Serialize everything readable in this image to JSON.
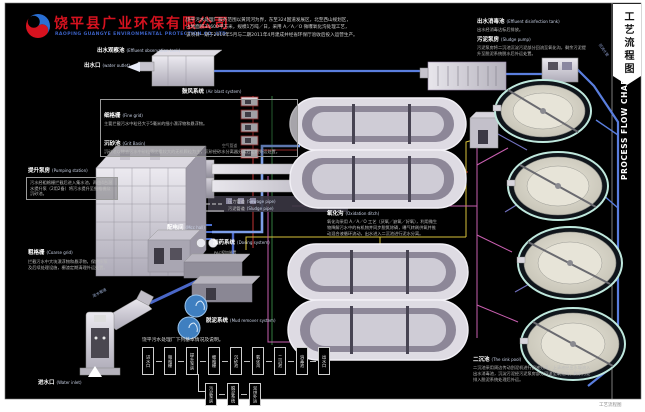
{
  "page": {
    "bg": "#000000",
    "margin_bg": "#ffffff",
    "footer_note": "工艺流程图"
  },
  "header": {
    "company_cn": "饶平县广业环保有限公司",
    "company_en": "RAOPING GUANGYE ENVIRONMENTAL PROTECTION CO.,LTD",
    "intro_lines": [
      "饶平污水处理厂服务范围以黄冈河为界，东至324国道发展区，北至西山规划区，",
      "占地面积34600平方米，规模1万吨／日，采用 A／A／O 微曝氧化沟处理工艺，",
      "该项目一期于2010年5月与二期2011年4月建成并经省环保厅验收后投入运营生产。"
    ]
  },
  "sidebar": {
    "tab_title_cn": "工艺流程图",
    "title_en": "PROCESS FLOW CHART"
  },
  "labels": {
    "effluent_observation_tank": {
      "cn": "出水观察池",
      "en": "(Effluent observation tank)"
    },
    "water_outlet": {
      "cn": "出水口",
      "en": "(water outlet)"
    },
    "air_blast_system": {
      "cn": "鼓风系统",
      "en": "(Air blast system)"
    },
    "air_pipe": "空气管道",
    "fine_grid": {
      "cn": "细格栅",
      "en": "(Fine grid)",
      "desc": "主要拦截污水中粒径大于5毫米的细小漂浮物和悬浮物。"
    },
    "grit_basin": {
      "cn": "沉砂池",
      "en": "(Grit Basin)",
      "desc": "沉砂池以除去污水中砂粒等比重较大的无机颗粒为主，沉砂经砂水分离器分离后定期外运处置。"
    },
    "pumping_station": {
      "cn": "提升泵房",
      "en": "(Pumping station)",
      "desc": "污水经粗格栅拦截后进入集水池，再由4台潜水提升泵（2用2备）将污水提升至细格栅及沉砂池。"
    },
    "coarse_grid": {
      "cn": "粗格栅",
      "en": "(Coarse grid)",
      "desc": "拦截污水中大块漂浮物和悬浮物，保护水泵及后续处理设施，栅渣定期清理外运处置。"
    },
    "water_inlet": {
      "cn": "进水口",
      "en": "(Water inlet)"
    },
    "inlet_pipe_label": "进水管道",
    "return_pipe_label": "回流水管",
    "mcc_hall": {
      "cn": "配电间",
      "en": "(Mcc hall)"
    },
    "dosing_system": {
      "cn": "加药系统",
      "en": "(Dosing system)",
      "sub": "PAC投加装置"
    },
    "mud_system": {
      "cn": "脱泥系统",
      "en": "(Mud remover system)"
    },
    "oxidation_ditch": {
      "cn": "氧化沟",
      "en": "(Oxidation ditch)",
      "desc": "氧化沟采用 A／A／O 工艺（厌氧／缺氧／好氧），利用微生物降解污水中的有机物并同步脱氮除磷，曝气转刷供氧并推动混合液循环流动，出水进入二沉池进行泥水分离。"
    },
    "disinfection_tank": {
      "cn": "出水消毒池",
      "en": "(Effluent disinfection tank)",
      "desc": "出水经消毒达标后排放。"
    },
    "sludge_pump": {
      "cn": "污泥泵房",
      "en": "(Sludge pump)",
      "desc": "污泥泵房将二沉池沉淀污泥部分回流至氧化沟，剩余污泥提升至脱泥系统脱水后外运处置。"
    },
    "secondary_clarifier": {
      "cn": "二沉池",
      "en": "(The sink pool)",
      "desc": "二沉池采用周边传动刮泥机进行固液分离，上清液经出水堰流入出水消毒池，沉淀污泥经污泥泵房部分回流至氧化沟，剩余污泥排入脱泥系统处理后外运。"
    }
  },
  "legend": {
    "items": [
      {
        "cn": "压力管道",
        "en": "(Sewage pipe)"
      },
      {
        "cn": "污泥管道",
        "en": "(Sludge pipe)"
      }
    ]
  },
  "mini_flow": {
    "title": "饶平污水处理厂下列基本情况及说明。",
    "main_steps": [
      "进水口",
      "粗格栅",
      "提升泵房",
      "细格栅",
      "沉砂池",
      "氧化沟",
      "二沉池",
      "消毒池",
      "出水口"
    ],
    "branch_steps": [
      "污泥泵房",
      "脱泥系统",
      "泥饼外运"
    ]
  },
  "colors": {
    "accent_red": "#d6121f",
    "accent_blue": "#2a52be",
    "pipe_blue": "#5a7ede",
    "pipe_red": "#c23434",
    "pipe_yellow": "#d8c23a",
    "pipe_magenta": "#c95fb0",
    "pipe_green": "#3f9a50",
    "pipe_purple": "#8585e0"
  }
}
